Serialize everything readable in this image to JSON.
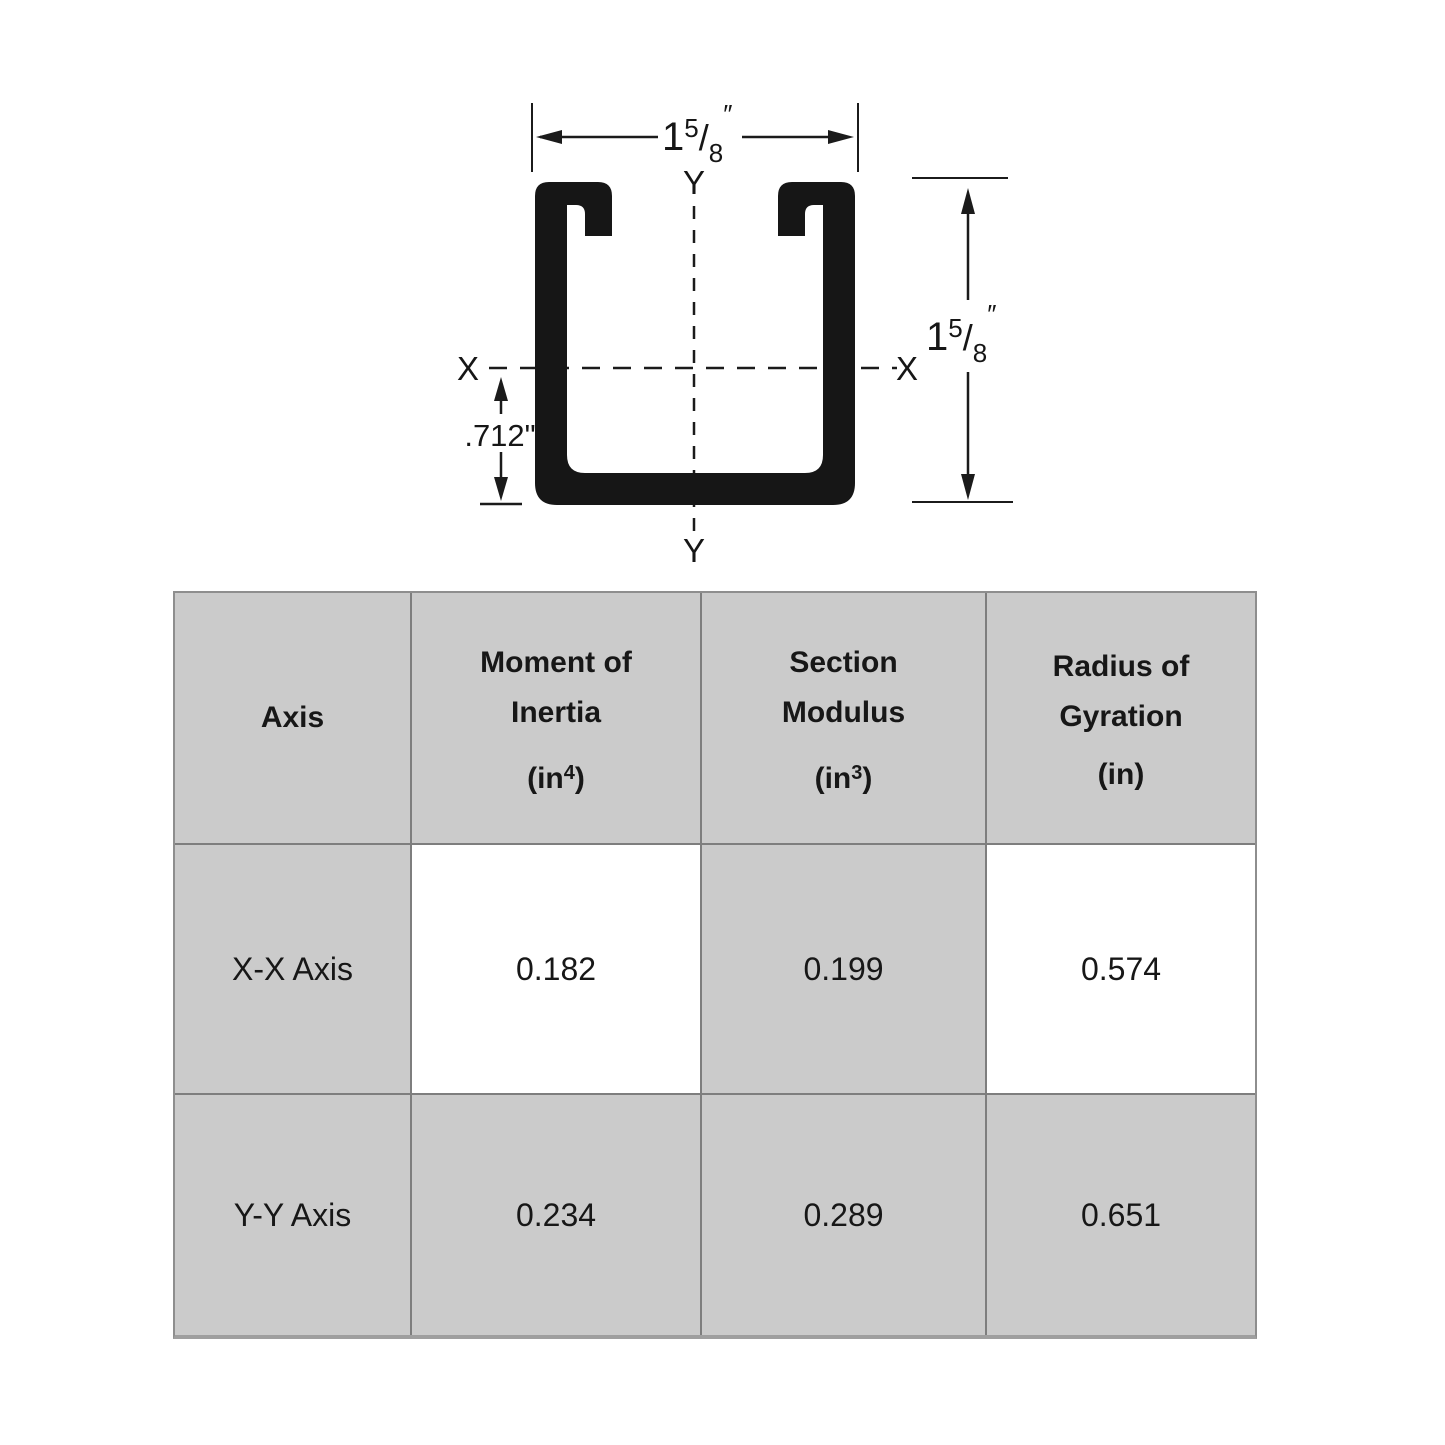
{
  "diagram": {
    "width_dim": {
      "whole": "1",
      "numerator": "5",
      "slash": "/",
      "denominator": "8",
      "unit": "″"
    },
    "height_dim": {
      "whole": "1",
      "numerator": "5",
      "slash": "/",
      "denominator": "8",
      "unit": "″"
    },
    "offset_dim": ".712\"",
    "axis": {
      "x_left": "X",
      "x_right": "X",
      "y_top": "Y",
      "y_bottom": "Y"
    },
    "colors": {
      "shape_black": "#161616"
    }
  },
  "table": {
    "header": {
      "axis": "Axis",
      "moment": {
        "line1": "Moment of",
        "line2": "Inertia",
        "unit_open": "(in",
        "unit_sup": "4",
        "unit_close": ")"
      },
      "section": {
        "line1": "Section",
        "line2": "Modulus",
        "unit_open": "(in",
        "unit_sup": "3",
        "unit_close": ")"
      },
      "radius": {
        "line1": "Radius of",
        "line2": "Gyration",
        "unit": "(in)"
      }
    },
    "rows": [
      {
        "axis": "X-X Axis",
        "moment": "0.182",
        "section": "0.199",
        "radius": "0.574"
      },
      {
        "axis": "Y-Y Axis",
        "moment": "0.234",
        "section": "0.289",
        "radius": "0.651"
      }
    ],
    "colors": {
      "cell_gray": "#cbcbcb",
      "grid_line": "#7e7e7e",
      "outer_border": "#8e8e8e"
    }
  }
}
